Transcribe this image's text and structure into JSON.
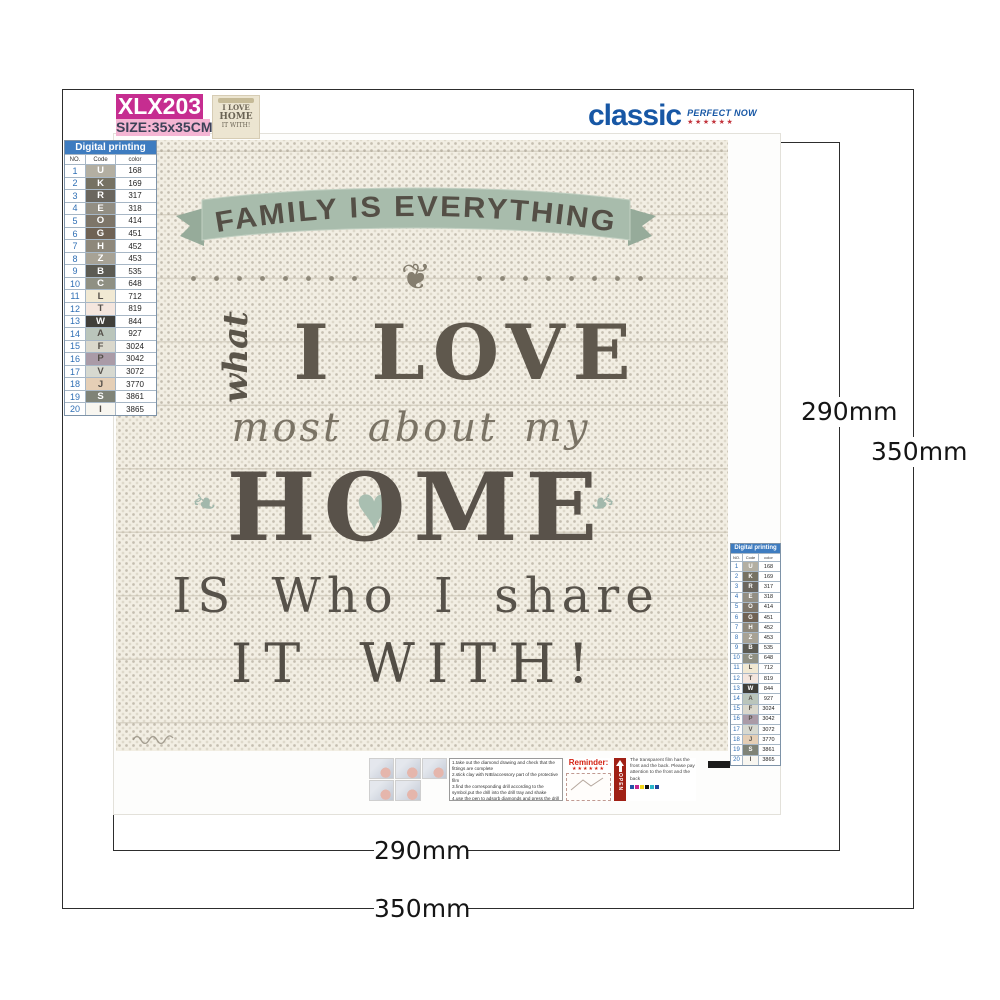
{
  "product_label": {
    "code": "XLX203",
    "size": "SIZE:35x35CM"
  },
  "brand": {
    "name": "classic",
    "tagline": "PERFECT NOW",
    "stars": "★★★★★★"
  },
  "dimensions": {
    "design": "290mm",
    "canvas": "350mm"
  },
  "palette": {
    "title": "Digital printing",
    "columns": [
      "NO.",
      "Code",
      "color"
    ],
    "rows": [
      {
        "no": "1",
        "code": "U",
        "color": "168",
        "bg": "#b3afa2",
        "fg": "#ffffff"
      },
      {
        "no": "2",
        "code": "K",
        "color": "169",
        "bg": "#767263",
        "fg": "#ffffff"
      },
      {
        "no": "3",
        "code": "R",
        "color": "317",
        "bg": "#6a665e",
        "fg": "#ffffff"
      },
      {
        "no": "4",
        "code": "E",
        "color": "318",
        "bg": "#928e83",
        "fg": "#ffffff"
      },
      {
        "no": "5",
        "code": "O",
        "color": "414",
        "bg": "#7d7569",
        "fg": "#ffffff"
      },
      {
        "no": "6",
        "code": "G",
        "color": "451",
        "bg": "#6f6254",
        "fg": "#ffffff"
      },
      {
        "no": "7",
        "code": "H",
        "color": "452",
        "bg": "#8e887b",
        "fg": "#ffffff"
      },
      {
        "no": "8",
        "code": "Z",
        "color": "453",
        "bg": "#a7a295",
        "fg": "#ffffff"
      },
      {
        "no": "9",
        "code": "B",
        "color": "535",
        "bg": "#5c5b53",
        "fg": "#ffffff"
      },
      {
        "no": "10",
        "code": "C",
        "color": "648",
        "bg": "#8f9083",
        "fg": "#ffffff"
      },
      {
        "no": "11",
        "code": "L",
        "color": "712",
        "bg": "#f1e9d3",
        "fg": "#55504a"
      },
      {
        "no": "12",
        "code": "T",
        "color": "819",
        "bg": "#f4e6de",
        "fg": "#55504a"
      },
      {
        "no": "13",
        "code": "W",
        "color": "844",
        "bg": "#403f3a",
        "fg": "#ffffff"
      },
      {
        "no": "14",
        "code": "A",
        "color": "927",
        "bg": "#bac5bb",
        "fg": "#55504a"
      },
      {
        "no": "15",
        "code": "F",
        "color": "3024",
        "bg": "#dad8cc",
        "fg": "#55504a"
      },
      {
        "no": "16",
        "code": "P",
        "color": "3042",
        "bg": "#aa9ba7",
        "fg": "#55504a"
      },
      {
        "no": "17",
        "code": "V",
        "color": "3072",
        "bg": "#d7d9d0",
        "fg": "#55504a"
      },
      {
        "no": "18",
        "code": "J",
        "color": "3770",
        "bg": "#e5cfb6",
        "fg": "#55504a"
      },
      {
        "no": "19",
        "code": "S",
        "color": "3861",
        "bg": "#7f8377",
        "fg": "#ffffff"
      },
      {
        "no": "20",
        "code": "I",
        "color": "3865",
        "bg": "#f8f6f0",
        "fg": "#55504a"
      }
    ]
  },
  "artwork": {
    "banner": "FAMILY IS EVERYTHING",
    "line_what": "what",
    "line_ilove": "I LOVE",
    "line_most": "most about my",
    "line_home": "HOME",
    "line_iswho": "IS Who I share",
    "line_itwith": "IT WITH!",
    "heart": "♥",
    "ornament": "❦",
    "flourish": "❧",
    "thumbnail": {
      "line1": "I LOVE",
      "line2": "HOME",
      "line3": "IT WITH!"
    }
  },
  "instructions": {
    "steps": [
      "1.take out the diamond drawing and check that the fittings are complete",
      "2.stick clay with NIB/accessory part of the protective film",
      "3.find the corresponding drill according to the symbol,put the drill into the drill tray and shake",
      "4.use the pen to adsorb diamonds and press the drill to the corresponding position",
      "5.finally use a book to press the drill on the canvas,so as not to lose the drill"
    ],
    "reminder_label": "Reminder:",
    "reminder_stars": "★★★★★★",
    "open_label": "OPEN",
    "note": "The transparent film has the front and the back. Please pay attention to the front and the back",
    "cmyk": [
      "#2057a7",
      "#c2258f",
      "#f0d418",
      "#111111",
      "#2ab6c9",
      "#20449a"
    ]
  },
  "colors": {
    "banner_green": "#a8bcac",
    "label_magenta": "#c62d90",
    "label_pink": "#f4b5d3",
    "table_header_blue": "#3e7cc0",
    "brand_blue": "#1757a5",
    "star_red": "#c2333c",
    "reminder_red": "#d42314",
    "open_red": "#a02015",
    "canvas_cream": "#f2eee3"
  }
}
